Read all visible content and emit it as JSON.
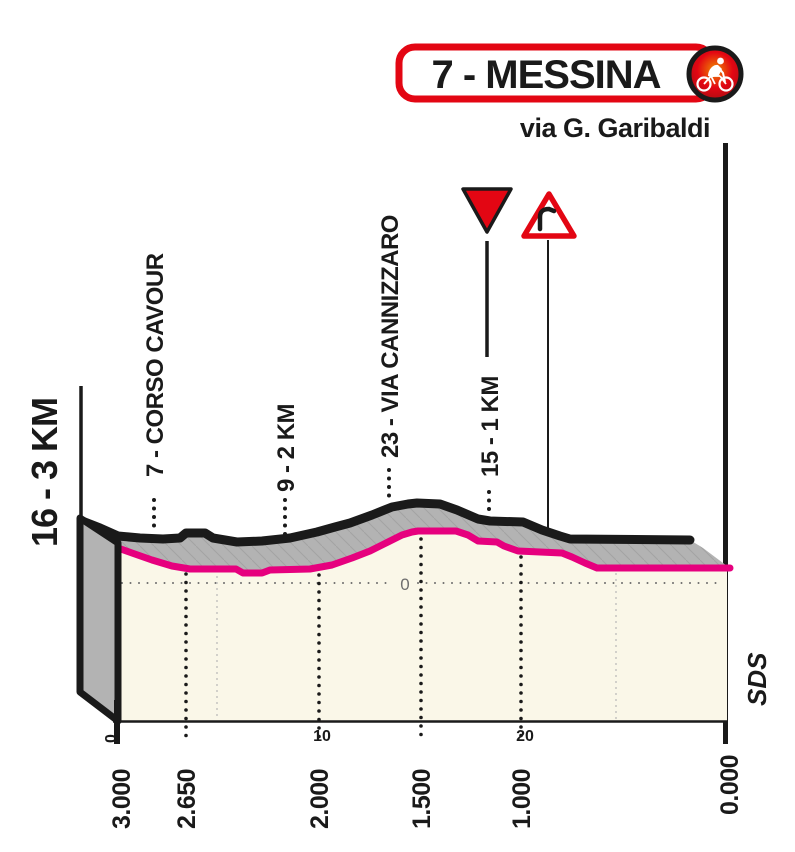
{
  "header": {
    "stage_label": "7 - MESSINA",
    "finish_street": "via G. Garibaldi"
  },
  "profile_labels": {
    "left_edge": "16 - 3 KM",
    "corso_cavour": "7 - CORSO CAVOUR",
    "km2": "9 - 2 KM",
    "via_cannizzaro": "23 - VIA CANNIZZARO",
    "km1": "15 - 1 KM"
  },
  "axis": {
    "distance_labels": [
      "3.000",
      "2.650",
      "2.000",
      "1.500",
      "1.000",
      "0.000"
    ],
    "scale_marks": [
      "0",
      "10",
      "20"
    ],
    "sea_level_label": "0"
  },
  "branding": {
    "credit": "SDS"
  },
  "icons": {
    "stage_icon": "sprint-cyclist-icon",
    "route_marker": "inverted-red-triangle-icon",
    "hazard_sign": "dangerous-bend-icon"
  },
  "colors": {
    "giro_pink": "#E6007E",
    "giro_red": "#E30613",
    "profile_fill": "#FAF7E8",
    "surface_gray": "#B3B3B3",
    "outline_black": "#1A1A1A"
  },
  "chart_data": {
    "type": "area",
    "title": "7 - MESSINA",
    "subtitle": "via G. Garibaldi",
    "xlabel": "distance to finish (m)",
    "ylabel": "elevation (m)",
    "x_ticks_m": [
      3000,
      2650,
      2000,
      1500,
      1000,
      0
    ],
    "secondary_scale_marks": [
      0,
      10,
      20
    ],
    "sea_level_gridline": 0,
    "grid": "dotted",
    "legend": "none",
    "series": [
      {
        "name": "elevation profile ultimi km",
        "x_m_to_finish": [
          3000,
          2900,
          2800,
          2700,
          2650,
          2550,
          2450,
          2400,
          2300,
          2200,
          2100,
          2000,
          1900,
          1800,
          1700,
          1600,
          1500,
          1450,
          1400,
          1300,
          1250,
          1150,
          1100,
          1050,
          1000,
          900,
          800,
          700,
          650,
          600,
          100,
          0
        ],
        "elevation_m": [
          21,
          18,
          14,
          11,
          9,
          8,
          8,
          6,
          6,
          7,
          8,
          8,
          11,
          15,
          19,
          26,
          30,
          31,
          31,
          28,
          25,
          24,
          24,
          22,
          19,
          18,
          18,
          15,
          12,
          9,
          9,
          9
        ]
      }
    ],
    "annotations": [
      {
        "x_m_to_finish": 3000,
        "label": "16 - 3 KM"
      },
      {
        "x_m_to_finish": 2800,
        "label": "7 - CORSO CAVOUR"
      },
      {
        "x_m_to_finish": 2000,
        "label": "9 - 2 KM"
      },
      {
        "x_m_to_finish": 1500,
        "label": "23 - VIA CANNIZZARO"
      },
      {
        "x_m_to_finish": 1000,
        "label": "15 - 1 KM"
      },
      {
        "x_m_to_finish": 850,
        "label": "dangerous bend",
        "icon": "dangerous-bend-icon"
      },
      {
        "x_m_to_finish": 0,
        "label": "finish line — via G. Garibaldi"
      }
    ]
  },
  "svg_paths": {
    "pink_line": "M118,548 L132,553 L152,560 L172,566 L190,569 L236,569 L243,573 L262,573 L270,570 L310,569 L332,565 L352,558 L370,551 L388,542 L402,535 L412,532 L418,531 L456,531 L468,535 L478,541 L497,542 L504,546 L518,551 L540,552 L562,553 L572,557 L585,563 L597,568 L730,568",
    "black_top": "M82,521 L100,528 L118,536 L140,538 L163,539 L180,538 L186,533 L205,533 L213,538 L237,542 L262,541 L290,538 L317,532 L335,527 L350,523 L372,515 L392,507 L408,504 L417,503 L440,504 L457,510 L478,519 L490,521 L523,522 L542,530 L560,536 L570,539 L690,540",
    "gray_band": "M82,521 L100,528 L118,536 L140,538 L163,539 L180,538 L186,533 L205,533 L213,538 L237,542 L262,541 L290,538 L317,532 L335,527 L350,523 L372,515 L392,507 L408,504 L417,503 L440,504 L457,510 L478,519 L490,521 L523,522 L542,530 L560,536 L570,539 L690,540 L703,548 L727,566 L727,568 L597,568 L585,563 L572,557 L562,553 L540,552 L518,551 L504,546 L497,542 L478,541 L468,535 L456,531 L418,531 L412,532 L402,535 L388,542 L370,551 L352,558 L332,565 L310,569 L270,570 L262,573 L243,573 L236,569 L190,569 L172,566 L152,560 L132,553 L118,548 Z",
    "cream_area": "M118,548 L132,553 L152,560 L172,566 L190,569 L236,569 L243,573 L262,573 L270,570 L310,569 L332,565 L352,558 L370,551 L388,542 L402,535 L412,532 L418,531 L456,531 L468,535 L478,541 L497,542 L504,546 L518,551 L540,552 L562,553 L572,557 L585,563 L597,568 L727,568 L727,721 L118,721 Z",
    "left_face": "M80,518 L118,543 L118,721 L80,692 Z"
  }
}
